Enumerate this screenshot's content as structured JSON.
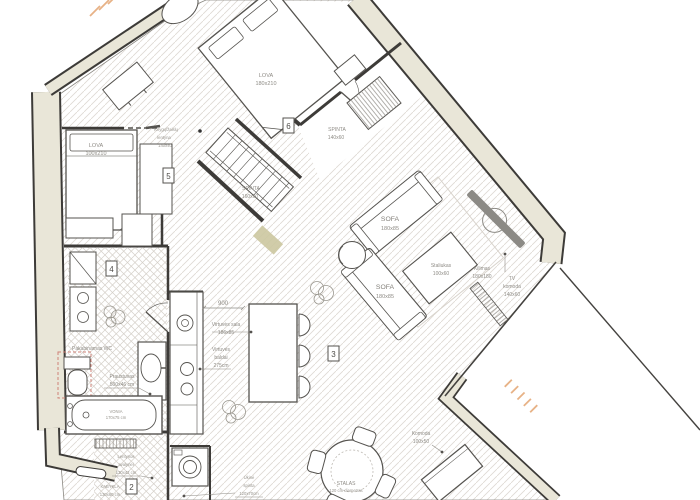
{
  "palette": {
    "wall_fill": "#e9e6d8",
    "wall_line": "#3d3b38",
    "furniture_line": "#55534f",
    "floor_hatch": "#ded9d3",
    "tile_hatch": "#d4cfc8",
    "label_text": "#8f8c86",
    "accent_peach": "#e7b286",
    "accent_red_dash": "#cf8379",
    "mat_olive": "#ccc7a0"
  },
  "markers": {
    "m2": "2",
    "m3": "3",
    "m4": "4",
    "m5": "5",
    "m6": "6"
  },
  "rooms": {
    "bedroom_top": {
      "bed_name": "LOVA",
      "bed_size": "180x210",
      "wardrobe_name": "SPINTA",
      "wardrobe_size": "140x60"
    },
    "hall": {
      "wardrobe_name": "SPINTA",
      "wardrobe_size": "160x60"
    },
    "bedroom_left": {
      "bed_name": "LOVA",
      "bed_size": "100x210",
      "shelf_line1": "Knygų/žaislų",
      "shelf_line2": "lentyna",
      "shelf_line3": "140x40"
    },
    "bathroom": {
      "wc_label": "Pakabinamas WC",
      "sink_name": "Praustuvas",
      "sink_size": "500x46 cm",
      "bath_name": "VONIA",
      "bath_size": "170x75 cm"
    },
    "kitchen": {
      "door_dim": "900",
      "island_line1": "Virtuvės sala",
      "island_line2": "186x85",
      "units_line1": "Virtuvės",
      "units_line2": "baldai",
      "units_line3": "275cm"
    },
    "living": {
      "sofa1_name": "SOFA",
      "sofa1_size": "180x85",
      "sofa2_name": "SOFA",
      "sofa2_size": "180x85",
      "coffee_table_name": "Staliukas",
      "coffee_table_size": "100x60",
      "rug_name": "Kilimas",
      "rug_size": "180x180",
      "tv_line1": "TV",
      "tv_line2": "komoda",
      "tv_line3": "140x60"
    },
    "dining": {
      "table_name": "STALAS",
      "table_size": "120 cm diametras",
      "komoda_name": "Komoda",
      "komoda_size": "100x50"
    },
    "entry": {
      "shoes_line1": "Lentynos",
      "shoes_line2": "avalynei",
      "shoes_line3": "130x42 cm",
      "rack_name": "KABYKLA",
      "rack_size": "130x60 cm",
      "utility_line1": "Ūkinė",
      "utility_line2": "spinta",
      "utility_line3": "120x70cm"
    }
  }
}
